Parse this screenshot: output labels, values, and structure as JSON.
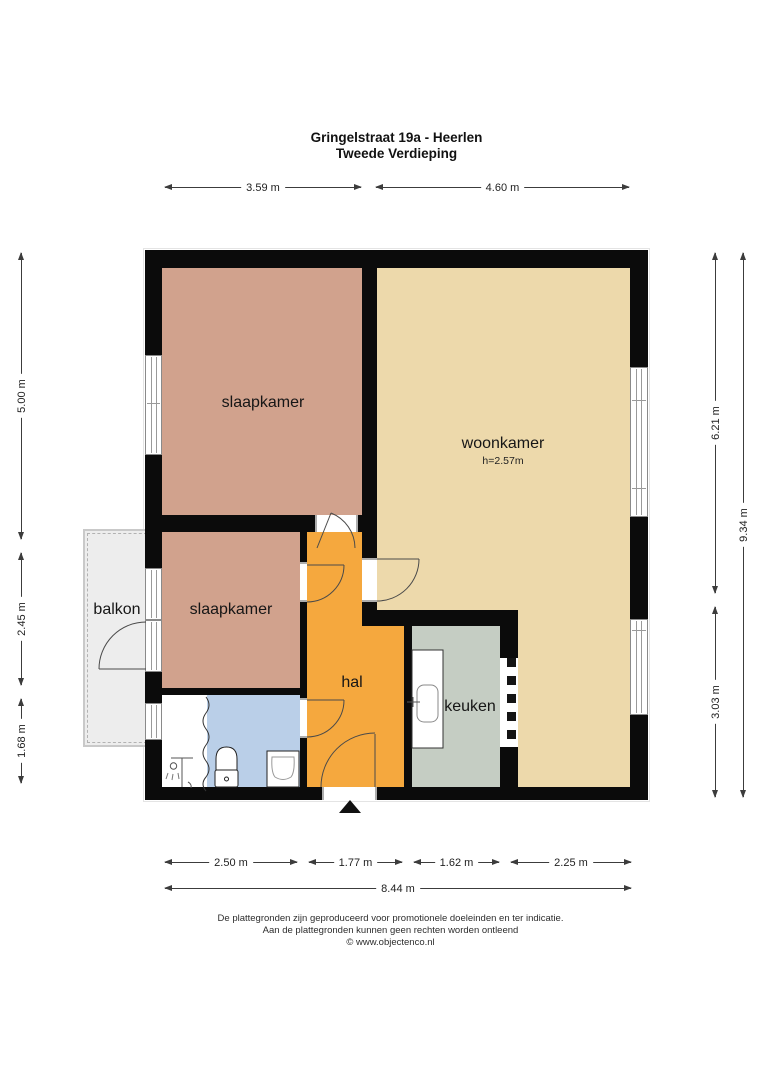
{
  "title": {
    "line1": "Gringelstraat 19a - Heerlen",
    "line2": "Tweede Verdieping"
  },
  "rooms": {
    "slaapkamer1": {
      "label": "slaapkamer"
    },
    "slaapkamer2": {
      "label": "slaapkamer"
    },
    "woonkamer": {
      "label": "woonkamer",
      "height_note": "h=2.57m"
    },
    "hal": {
      "label": "hal"
    },
    "keuken": {
      "label": "keuken"
    },
    "balkon": {
      "label": "balkon"
    }
  },
  "dimensions": {
    "top": [
      {
        "label": "3.59 m"
      },
      {
        "label": "4.60 m"
      }
    ],
    "left": [
      {
        "label": "5.00 m"
      },
      {
        "label": "2.45 m"
      },
      {
        "label": "1.68 m"
      }
    ],
    "right": [
      {
        "label": "6.21 m"
      },
      {
        "label": "3.03 m"
      },
      {
        "label": "9.34 m"
      }
    ],
    "bottom": [
      {
        "label": "2.50 m"
      },
      {
        "label": "1.77 m"
      },
      {
        "label": "1.62 m"
      },
      {
        "label": "2.25 m"
      }
    ],
    "bottom_total": {
      "label": "8.44 m"
    }
  },
  "footer": {
    "line1": "De plattegronden zijn geproduceerd voor promotionele doeleinden en ter indicatie.",
    "line2": "Aan de plattegronden kunnen geen rechten worden ontleend",
    "line3": "© www.objectenco.nl"
  },
  "icons": {
    "north_arrow": "triangle-up"
  },
  "colors": {
    "bedroom": "#d1a28d",
    "living": "#edd9ab",
    "hall": "#f5a83e",
    "kitchen": "#c5cdc3",
    "bathroom": "#bacfe8",
    "balcony": "#ededed",
    "wall": "#0b0b0b"
  }
}
